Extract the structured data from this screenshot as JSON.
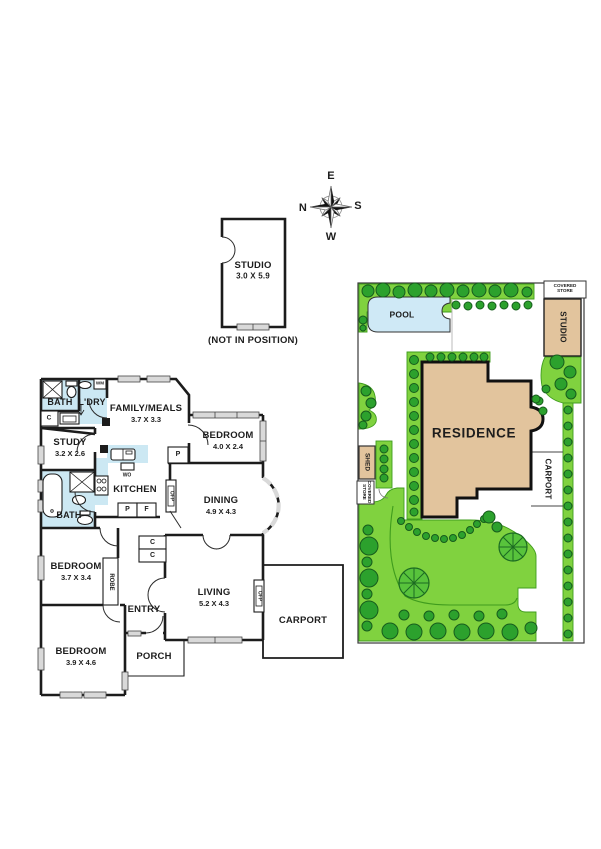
{
  "compass": {
    "east": "E",
    "south": "S",
    "west": "W",
    "north": "N"
  },
  "detached_studio": {
    "name": "STUDIO",
    "dims": "3.0 X 5.9",
    "note": "(NOT IN POSITION)"
  },
  "floorplan": {
    "rooms": {
      "bath1": {
        "name": "BATH"
      },
      "laundry": {
        "name": "L'DRY"
      },
      "family_meals": {
        "name": "FAMILY/MEALS",
        "dims": "3.7 X 3.3"
      },
      "study": {
        "name": "STUDY",
        "dims": "3.2 X 2.6"
      },
      "kitchen": {
        "name": "KITCHEN"
      },
      "bath2": {
        "name": "BATH"
      },
      "bedroom1": {
        "name": "BEDROOM",
        "dims": "4.0 X 2.4"
      },
      "dining": {
        "name": "DINING",
        "dims": "4.9 X 4.3"
      },
      "bedroom2": {
        "name": "BEDROOM",
        "dims": "3.7 X 3.4"
      },
      "entry": {
        "name": "ENTRY"
      },
      "living": {
        "name": "LIVING",
        "dims": "5.2 X 4.3"
      },
      "bedroom3": {
        "name": "BEDROOM",
        "dims": "3.9 X 4.6"
      },
      "porch": {
        "name": "PORCH"
      },
      "carport": {
        "name": "CARPORT"
      }
    },
    "fixtures": {
      "washing_machine": "WM",
      "wall_oven": "WO",
      "cupboard": "C",
      "pantry": "P",
      "fridge": "F",
      "robe": "ROBE",
      "fireplace": "OFP"
    }
  },
  "siteplan": {
    "labels": {
      "pool": "POOL",
      "residence": "RESIDENCE",
      "studio": "STUDIO",
      "shed": "SHED",
      "covered_store": "COVERED STORE",
      "carport": "CARPORT"
    },
    "colors": {
      "lawn": "#80d23f",
      "bush": "#2ca12d",
      "pool_water": "#cfe9f6",
      "building": "#e2c49d",
      "wet_area": "#cce8f3",
      "wall": "#1c1c1c",
      "window": "#d9d9d9"
    }
  }
}
